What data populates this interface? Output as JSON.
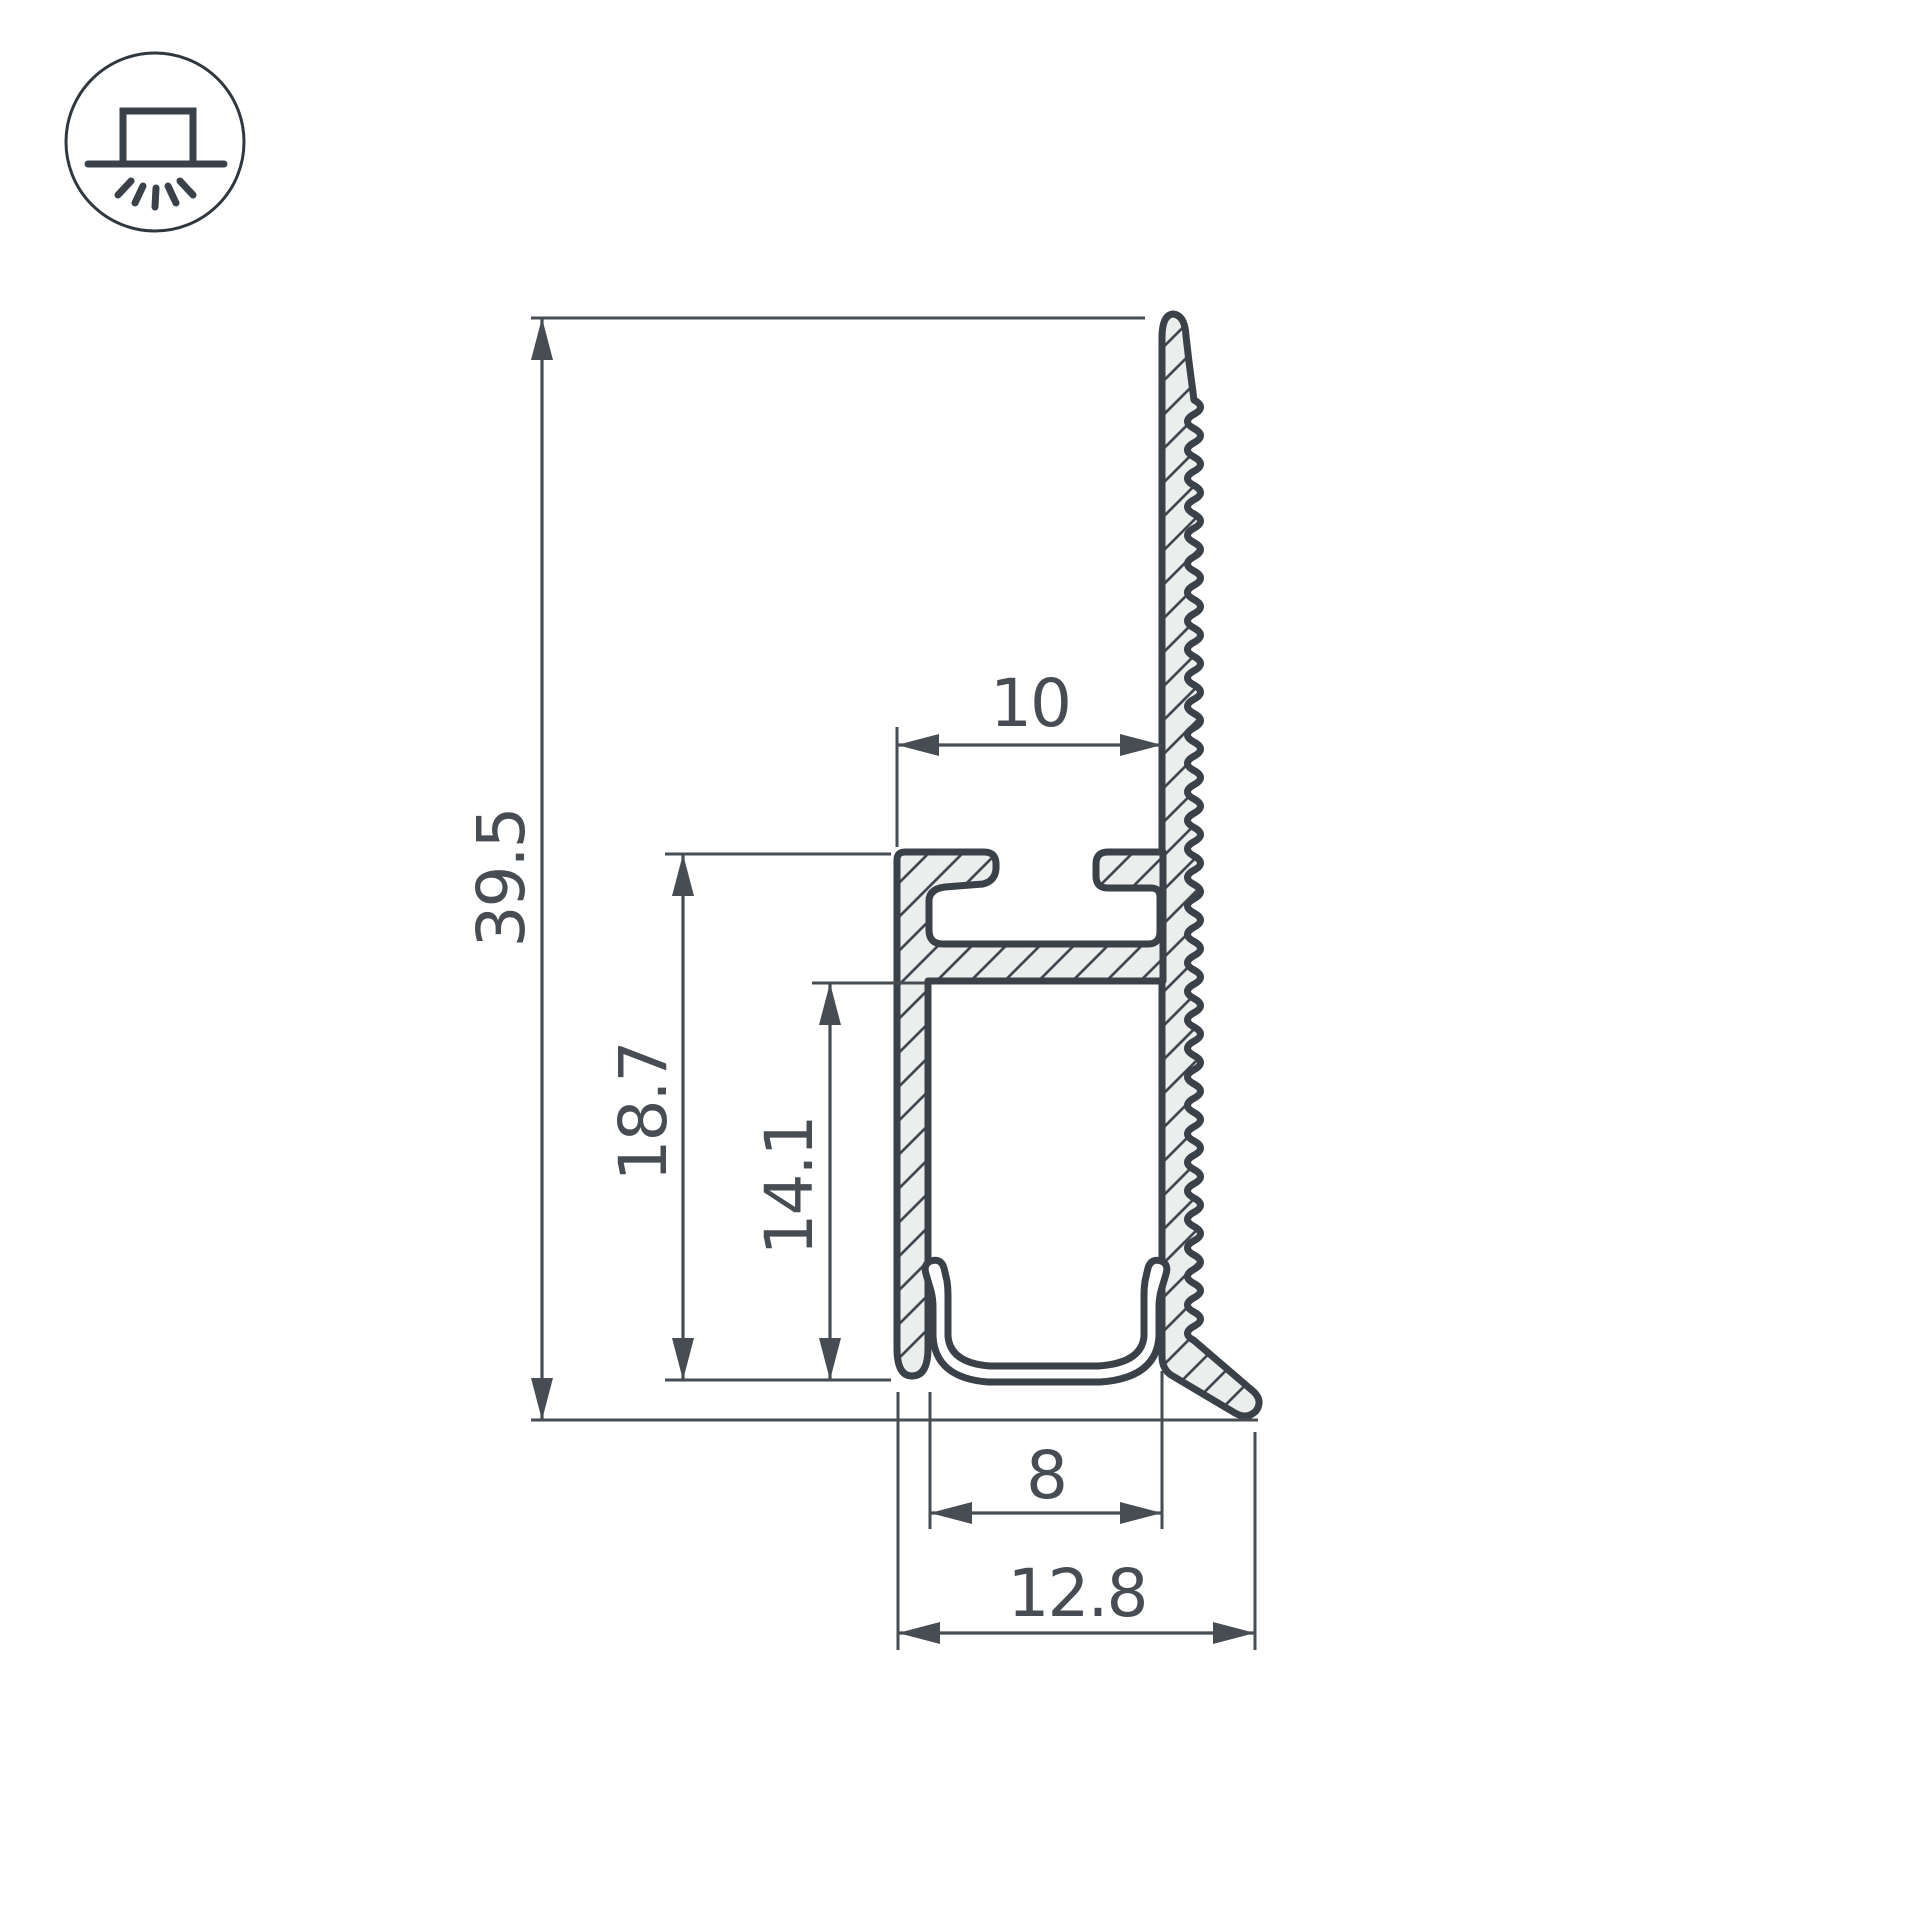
{
  "icon": {
    "name": "surface-mount-light"
  },
  "dimensions": {
    "overall_height": "39.5",
    "body_height": "18.7",
    "channel_depth": "14.1",
    "top_width": "10",
    "channel_width": "8",
    "base_width": "12.8"
  },
  "colors": {
    "background": "#FFFFFF",
    "outline": "#3A4149",
    "dimension": "#474D53",
    "fill": "#ECEDED"
  }
}
